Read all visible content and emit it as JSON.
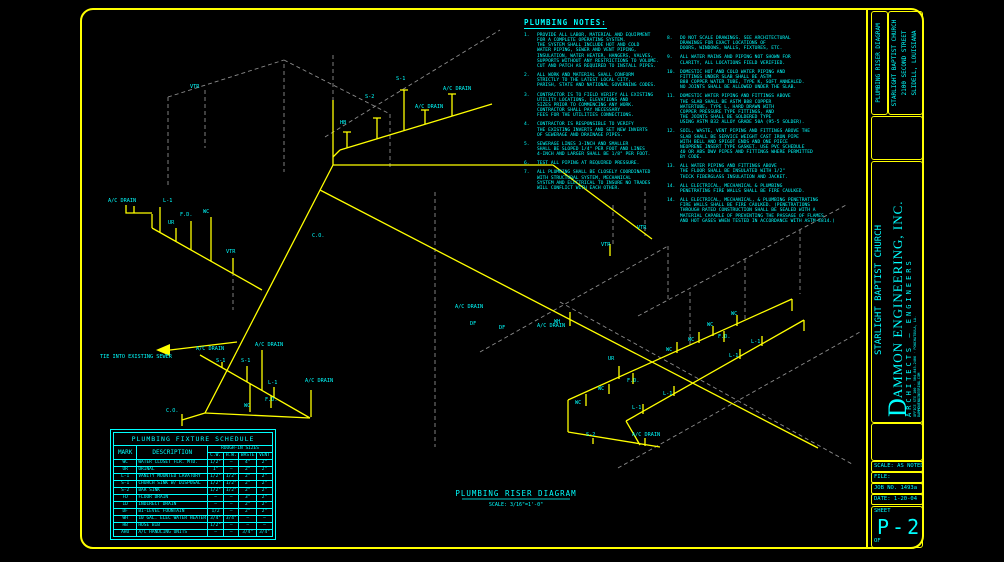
{
  "colors": {
    "line": "#ffff00",
    "text": "#00ffff",
    "dashed": "#8c8c8c",
    "bg": "#000000"
  },
  "sheet": {
    "notes_title": "PLUMBING NOTES:",
    "diagram_title": "PLUMBING RISER DIAGRAM",
    "diagram_scale": "SCALE: 3/16\"=1'-0\""
  },
  "notes_left": [
    {
      "num": "1.",
      "lines": [
        "PROVIDE ALL LABOR, MATERIAL AND EQUIPMENT",
        "FOR A COMPLETE OPERATING SYSTEM.",
        "THE SYSTEM SHALL INCLUDE HOT AND COLD",
        "WATER PIPING, SEWER AND VENT PIPING,",
        "INSULATION, WATER HEATER, HANGERS, VALVES,",
        "SUPPORTS WITHOUT ANY RESTRICTIONS TO VOLUME.",
        "CUT AND PATCH AS REQUIRED TO INSTALL PIPES."
      ]
    },
    {
      "num": "2.",
      "lines": [
        "ALL WORK AND MATERIAL SHALL CONFORM",
        "STRICTLY TO THE LATEST LOCAL CITY,",
        "PARISH, STATE AND NATIONAL GOVERNING CODES."
      ]
    },
    {
      "num": "3.",
      "lines": [
        "CONTRACTOR IS TO FIELD VERIFY ALL EXISTING",
        "UTILITY LOCATIONS, ELEVATIONS AND",
        "SIZES PRIOR TO COMMENCING ANY WORK.",
        "CONTRACTOR SHALL PAY NECESSARY",
        "FEES FOR THE UTILITIES CONNECTIONS."
      ]
    },
    {
      "num": "4.",
      "lines": [
        "CONTRACTOR IS RESPONSIBLE TO VERIFY",
        "THE EXISTING INVERTS AND SET NEW INVERTS",
        "OF SEWERAGE AND DRAINAGE PIPES."
      ]
    },
    {
      "num": "5.",
      "lines": [
        "SEWERAGE LINES 3-INCH AND SMALLER",
        "SHALL BE SLOPED 1/4\" PER FOOT AND LINES",
        "4-INCH AND LARGER SHALL BE 1/8\" PER FOOT."
      ]
    },
    {
      "num": "6.",
      "lines": [
        "TEST ALL PIPING AT REQUIRED PRESSURE."
      ]
    },
    {
      "num": "7.",
      "lines": [
        "ALL PLUMBING SHALL BE CLOSELY COORDINATED",
        "WITH STRUCTURAL SYSTEM, MECHANICAL",
        "SYSTEM AND ELECTRICAL TO INSURE NO TRADES",
        "WILL CONFLICT WITH EACH OTHER."
      ]
    }
  ],
  "notes_right": [
    {
      "num": "8.",
      "lines": [
        "DO NOT SCALE DRAWINGS.  SEE ARCHITECTURAL",
        "DRAWINGS FOR EXACT LOCATIONS OF",
        "DOORS, WINDOWS, WALLS, FIXTURES, ETC."
      ]
    },
    {
      "num": "9.",
      "lines": [
        "ALL WATER MAINS AND PIPING NOT SHOWN FOR",
        "CLARITY, ALL LOCATIONS FIELD VERIFIED."
      ]
    },
    {
      "num": "10.",
      "lines": [
        "DOMESTIC HOT AND COLD WATER PIPING AND",
        "FITTINGS UNDER SLAB SHALL BE ASTM",
        "B88 COPPER WATER TUBE, TYPE K, SOFT ANNEALED.",
        "NO JOINTS SHALL BE ALLOWED UNDER THE SLAB."
      ]
    },
    {
      "num": "11.",
      "lines": [
        "DOMESTIC WATER PIPING AND FITTINGS ABOVE",
        "THE SLAB SHALL BE ASTM B88 COPPER",
        "WATERTUBE, TYPE L,  HARD DRAWN WITH",
        "COPPER PRESSURE TYPE FITTINGS, AND",
        "THE JOINTS SHALL BE SOLDERED TYPE",
        "USING ASTM B32 ALLOY GRADE 50A (95-5 SOLDER)."
      ]
    },
    {
      "num": "12.",
      "lines": [
        "SOIL, WASTE, VENT PIPING AND FITTINGS ABOVE THE",
        "SLAB SHALL BE SERVICE WEIGHT CAST IRON PIPE",
        "WITH BELL AND SPIGOT ENDS AND ONE PIECE",
        "NEOPRENE INSERT TYPE GASKET.  USE PVC SCHEDULE",
        "40 OR ABS DWV PIPES AND FITTINGS WHERE PERMITTED",
        "BY CODE."
      ]
    },
    {
      "num": "13.",
      "lines": [
        "ALL WATER PIPING AND FITTINGS ABOVE",
        "THE FLOOR SHALL BE INSULATED WITH 1/2\"",
        "THICK FIBERGLASS INSULATION AND JACKET."
      ]
    },
    {
      "num": "14.",
      "lines": [
        "ALL ELECTRICAL, MECHANICAL & PLUMBING",
        "PENETRATING FIRE WALLS SHALL BE FIRE CAULKED."
      ]
    },
    {
      "num": "14.",
      "lines": [
        "ALL ELECTRICAL, MECHANICAL, & PLUMBING PENETRATING",
        "FIRE WALLS SHALL BE FIRE CAULKED.  (PENETRATIONS",
        "THROUGH RATED CONSTRUCTION SHALL BE SEALED WITH A",
        "MATERIAL CAPABLE OF PREVENTING THE PASSAGE OF FLAMES",
        "AND HOT GASES WHEN TESTED IN ACCORDANCE WITH ASTM-E814.)"
      ]
    }
  ],
  "schedule": {
    "title": "PLUMBING FIXTURE SCHEDULE",
    "col_mark": "MARK",
    "col_desc": "DESCRIPTION",
    "col_group": "ROUGH-IN SIZES",
    "sub_cols": [
      "C.W.",
      "H.W.",
      "WASTE",
      "VENT"
    ],
    "rows": [
      [
        "WC",
        "WATER CLOSET FLR. MTD.",
        "1/2\"",
        "—",
        "4\"",
        "2\""
      ],
      [
        "UR",
        "URINAL",
        "1\"",
        "—",
        "2\"",
        "2\""
      ],
      [
        "L-1",
        "VANITY MOUNTED LAVATORY",
        "1/2\"",
        "1/2\"",
        "2\"",
        "2\""
      ],
      [
        "S-1",
        "CHURCH SINK W/ DISPOSAL",
        "1/2\"",
        "1/2\"",
        "2\"",
        "2\""
      ],
      [
        "S-2",
        "BAR SINK",
        "1/2\"",
        "1/2\"",
        "2\"",
        "2\""
      ],
      [
        "FD",
        "FLOOR DRAIN",
        "—",
        "—",
        "3\"",
        "2\""
      ],
      [
        "ID",
        "INDIRECT DRAIN",
        "—",
        "—",
        "2\"",
        "2\""
      ],
      [
        "DF",
        "BI-LEVEL FOUNTAIN",
        "1/2",
        "—",
        "2\"",
        "2\""
      ],
      [
        "WH",
        "10 GAL. ELEC WATER HEATER",
        "3/4\"",
        "3/4\"",
        "—",
        "—"
      ],
      [
        "HB",
        "HOSE BIB",
        "1/2\"",
        "—",
        "—",
        "—"
      ],
      [
        "AHU",
        "A/C HANDLING UNITS",
        "—",
        "—",
        "3/4\"",
        "3/4\""
      ]
    ]
  },
  "diagram": {
    "labels": [
      {
        "t": "VTR",
        "x": 190,
        "y": 88
      },
      {
        "t": "A/C DRAIN",
        "x": 108,
        "y": 202
      },
      {
        "t": "L-1",
        "x": 163,
        "y": 202
      },
      {
        "t": "F.D.",
        "x": 180,
        "y": 216
      },
      {
        "t": "WC",
        "x": 203,
        "y": 213
      },
      {
        "t": "UR",
        "x": 168,
        "y": 224
      },
      {
        "t": "VTR",
        "x": 226,
        "y": 253
      },
      {
        "t": "TIE INTO EXISTING SEWER",
        "x": 100,
        "y": 358
      },
      {
        "t": "A/C DRAIN",
        "x": 196,
        "y": 350
      },
      {
        "t": "S-1",
        "x": 216,
        "y": 362
      },
      {
        "t": "S-1",
        "x": 241,
        "y": 362
      },
      {
        "t": "A/C DRAIN",
        "x": 255,
        "y": 346
      },
      {
        "t": "L-1",
        "x": 268,
        "y": 384
      },
      {
        "t": "F.D.",
        "x": 265,
        "y": 401
      },
      {
        "t": "WC",
        "x": 244,
        "y": 407
      },
      {
        "t": "C.O.",
        "x": 166,
        "y": 412
      },
      {
        "t": "A/C DRAIN",
        "x": 305,
        "y": 382
      },
      {
        "t": "C.O.",
        "x": 312,
        "y": 237
      },
      {
        "t": "HB",
        "x": 340,
        "y": 124
      },
      {
        "t": "S-2",
        "x": 365,
        "y": 98
      },
      {
        "t": "S-1",
        "x": 396,
        "y": 80
      },
      {
        "t": "A/C DRAIN",
        "x": 415,
        "y": 108
      },
      {
        "t": "A/C DRAIN",
        "x": 443,
        "y": 90
      },
      {
        "t": "A/C DRAIN",
        "x": 455,
        "y": 308
      },
      {
        "t": "DF",
        "x": 470,
        "y": 325
      },
      {
        "t": "DF",
        "x": 499,
        "y": 329
      },
      {
        "t": "A/C DRAIN",
        "x": 537,
        "y": 327
      },
      {
        "t": "VTR",
        "x": 601,
        "y": 246
      },
      {
        "t": "VTR",
        "x": 637,
        "y": 229
      },
      {
        "t": "WH",
        "x": 554,
        "y": 323
      },
      {
        "t": "UR",
        "x": 608,
        "y": 360
      },
      {
        "t": "WC",
        "x": 575,
        "y": 404
      },
      {
        "t": "WC",
        "x": 598,
        "y": 390
      },
      {
        "t": "F.D.",
        "x": 627,
        "y": 382
      },
      {
        "t": "L-1",
        "x": 632,
        "y": 409
      },
      {
        "t": "L-1",
        "x": 663,
        "y": 395
      },
      {
        "t": "S-2",
        "x": 586,
        "y": 436
      },
      {
        "t": "A/C DRAIN",
        "x": 632,
        "y": 436
      },
      {
        "t": "WC",
        "x": 666,
        "y": 351
      },
      {
        "t": "WC",
        "x": 688,
        "y": 341
      },
      {
        "t": "F.D.",
        "x": 718,
        "y": 338
      },
      {
        "t": "WC",
        "x": 707,
        "y": 326
      },
      {
        "t": "WC",
        "x": 731,
        "y": 315
      },
      {
        "t": "L-1",
        "x": 729,
        "y": 357
      },
      {
        "t": "L-1",
        "x": 751,
        "y": 343
      }
    ]
  },
  "titleblock": {
    "project_type": "PLUMBING RISER DIAGRAM",
    "project_name": "STARLIGHT BAPTIST CHURCH",
    "project_addr1": "2100 SECOND STREET",
    "project_addr2": "SLIDELL, LOUISIANA",
    "client": "STARLIGHT BAPTIST CHURCH",
    "firm_initial": "D",
    "firm_name": "AMMON ENGINEERING, INC.",
    "firm_sub": "ARCHITECTS — ENGINEERS",
    "firm_line1": "OFFICE STE 100 · 504-845-2406 · PONCHATOULA, LA.",
    "firm_line2": "DAMMONENGINEERING.COM",
    "scale": "SCALE: AS NOTED",
    "file": "FILE:",
    "job": "JOB NO. 1493a",
    "date": "DATE: 1-20-04",
    "sheet_label": "SHEET",
    "sheet_no": "P-2",
    "of": "OF"
  }
}
